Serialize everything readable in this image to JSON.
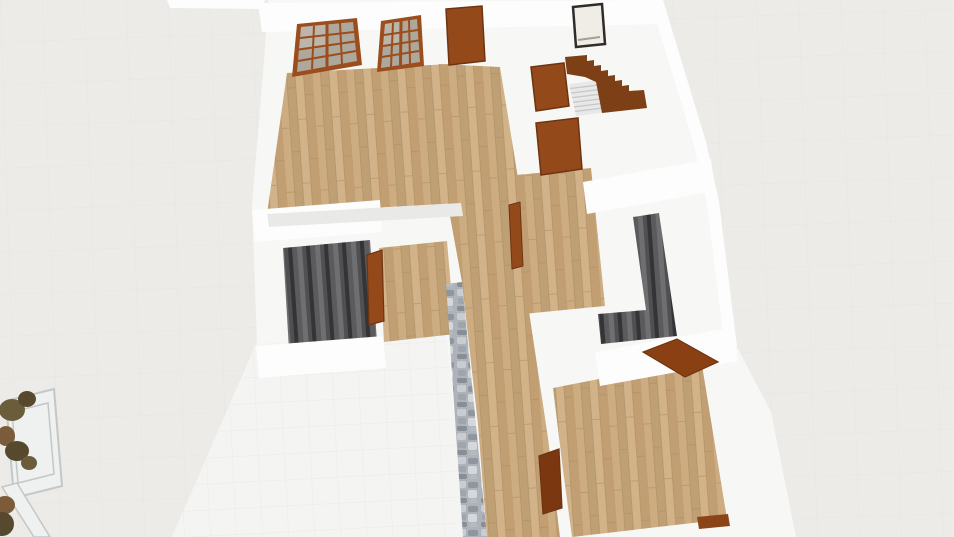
{
  "scene": {
    "app_context": "3d-floorplan-viewport",
    "view": "dollhouse-orbit",
    "viewport": {
      "width": 954,
      "height": 537
    },
    "colors": {
      "background": "#ECEBE8",
      "background_line": "#E3E1DE",
      "plan_white": "#F7F7F6",
      "wall_bright": "#FDFDFD",
      "shadow": "#E9E9E8",
      "tile": "#F4F4F2",
      "tile_line": "#E8E7E4",
      "wood_base": "#C7A67C",
      "wood_plank_a": "#CDAC82",
      "wood_plank_b": "#BFA074",
      "wood_plank_c": "#D2B389",
      "wood_plank_d": "#C19F72",
      "wood_line": "#AB8A60",
      "dark_base": "#454547",
      "dark_rib_a": "#343436",
      "dark_rib_b": "#5B5B5D",
      "dark_rib_c": "#6F6F71",
      "dark_rib_d": "#505052",
      "stone_base": "#AEB3BA",
      "stone_a": "#C9CDD2",
      "stone_b": "#8F969F",
      "stone_c": "#9EA5AD",
      "stone_d": "#D4D7DB",
      "stone_e": "#878E98",
      "stone_f": "#B6BBC1",
      "door_brown": "#94491B",
      "door_brown_dark": "#7B3710",
      "door_open": "#8A4012",
      "door_edge": "#6E3410",
      "frame_brown": "#9B4D1D",
      "glass": "#AEA89C",
      "glass_light": "#C7C2B8",
      "stair_brown": "#7D3F16",
      "step_gray": "#E8E8E8",
      "step_line": "#C9C9C9",
      "picture_frame": "#2F2C29",
      "picture_fill": "#F0EDE6",
      "baseboard": "#8A4418",
      "plant_olive": "#6B5C3B",
      "plant_dark": "#57492E",
      "plant_brown": "#7B5B39",
      "furniture_fill": "#EFF1F0",
      "furniture_line": "#C3C7C6"
    },
    "objects": [
      {
        "name": "lounge-room",
        "type": "room",
        "floor": "wood"
      },
      {
        "name": "hallway",
        "type": "room",
        "floor": "wood"
      },
      {
        "name": "middle-room",
        "type": "room",
        "floor": "wood"
      },
      {
        "name": "bottom-room",
        "type": "room",
        "floor": "wood"
      },
      {
        "name": "tile-room",
        "type": "room",
        "floor": "white-tile"
      },
      {
        "name": "stairwell-left",
        "type": "stair-opening",
        "floor": "dark-ribbed"
      },
      {
        "name": "stairwell-right",
        "type": "stair-opening",
        "floor": "dark-ribbed"
      },
      {
        "name": "french-door-1",
        "type": "glazed-double-door",
        "panes": "4x4"
      },
      {
        "name": "french-door-2",
        "type": "glazed-double-door",
        "panes": "4x4"
      },
      {
        "name": "entry-door-top",
        "type": "door"
      },
      {
        "name": "door-stair-hall",
        "type": "door"
      },
      {
        "name": "door-middle-room",
        "type": "door"
      },
      {
        "name": "door-alcove",
        "type": "door"
      },
      {
        "name": "door-hall-narrow",
        "type": "door"
      },
      {
        "name": "door-hall-bottom",
        "type": "door"
      },
      {
        "name": "door-open-bottom-room",
        "type": "door-open"
      },
      {
        "name": "staircase",
        "type": "stairs",
        "steps_visible": 7
      },
      {
        "name": "wall-art",
        "type": "framed-picture"
      },
      {
        "name": "stone-accent-wall",
        "type": "wall",
        "material": "stone"
      },
      {
        "name": "console-table",
        "type": "furniture"
      },
      {
        "name": "potted-plants",
        "type": "decor",
        "count": 7
      }
    ]
  }
}
